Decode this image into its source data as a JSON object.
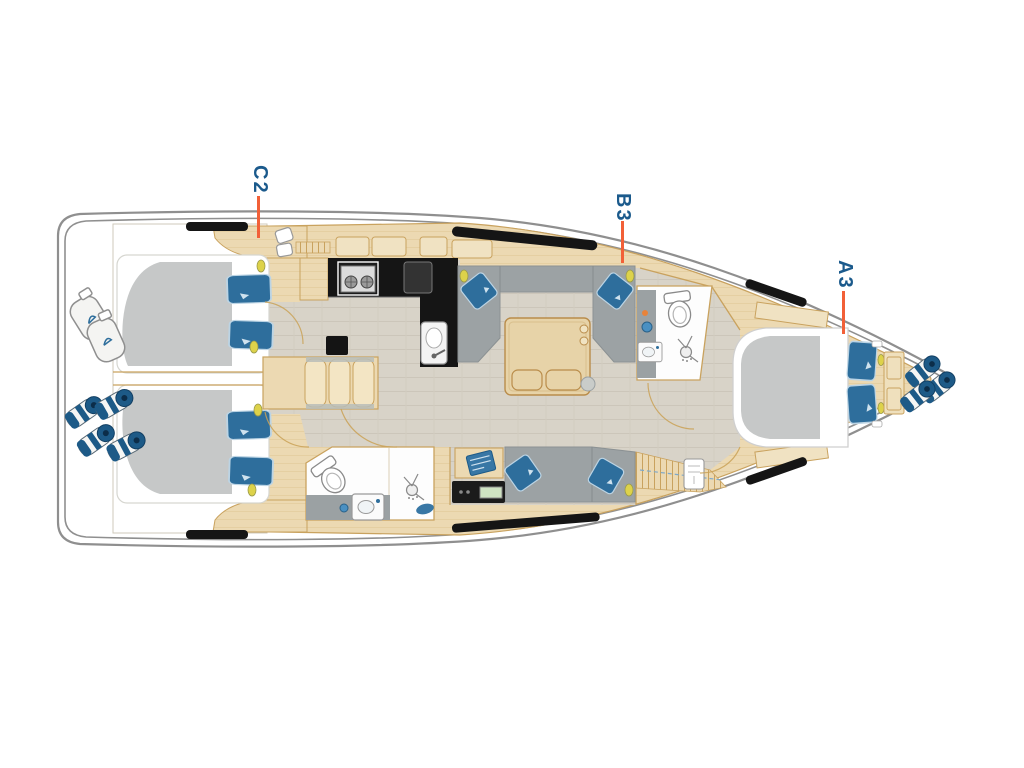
{
  "page": {
    "background": "#ffffff"
  },
  "diagram": {
    "type": "yacht-deck-floor-plan",
    "orientation": "bow-right",
    "cabin_labels": [
      {
        "id": "label-c2",
        "text": "C2"
      },
      {
        "id": "label-b3",
        "text": "B3"
      },
      {
        "id": "label-a3",
        "text": "A3"
      }
    ],
    "colors": {
      "label_text": "#1b5a8c",
      "leader_line": "#f26038",
      "hull_outline": "#8f8f8f",
      "wood": "#ecd9b2",
      "wood_edge": "#c9a25e",
      "wood_light": "#f0e2c2",
      "floor": "#d8d3c8",
      "upholstery_gray": "#9ca2a4",
      "mattress_gray": "#c6c8c8",
      "pillow_blue": "#2e6e9c",
      "fender_navy": "#1d5a87",
      "galley_counter_black": "#151515",
      "reading_light_yellow": "#ddd24a"
    },
    "icons": [
      "double-bed-icon",
      "pillow-icon",
      "toilet-icon",
      "shower-head-icon",
      "sink-icon",
      "stove-icon",
      "stairs-icon",
      "fender-icon",
      "reading-light-icon",
      "nav-instrument-panel-icon",
      "hull-window-icon"
    ]
  }
}
